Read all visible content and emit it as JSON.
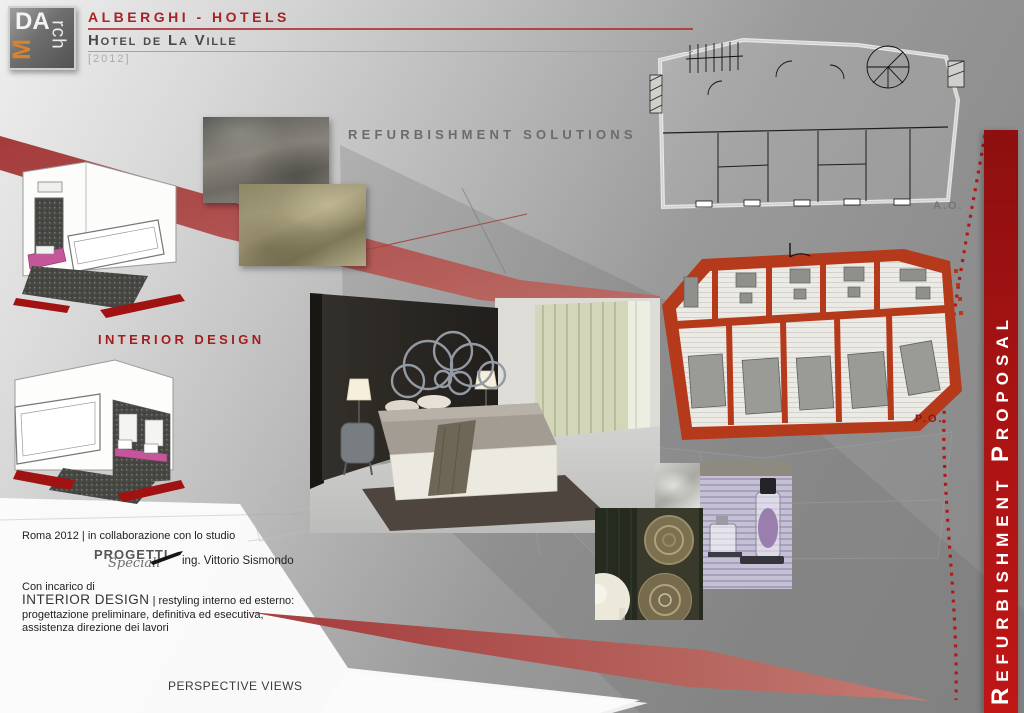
{
  "header": {
    "logo": {
      "part_da": "DA",
      "part_m": "M",
      "part_rch": "rch"
    },
    "category_label": "ALBERGHI - HOTELS",
    "project_title": "Hotel de La Ville",
    "project_year": "[2012]"
  },
  "labels": {
    "refurbishment_solutions": "REFURBISHMENT SOLUTIONS",
    "interior_design": "INTERIOR DESIGN",
    "perspective_views": "PERSPECTIVE VIEWS",
    "plan_ante_operam": "A.O.",
    "plan_post_operam": "P.O."
  },
  "sidebar": {
    "title": "Refurbishment Proposal"
  },
  "credits": {
    "collaboration_line": "Roma 2012 | in collaborazione con lo studio",
    "studio_name": "PROGETTI",
    "studio_name_script": "Speciali",
    "engineer_name": "ing. Vittorio Sismondo",
    "assignment_intro": "Con incarico di",
    "assignment_role": "INTERIOR DESIGN",
    "assignment_detail_1": "| restyling interno ed esterno:",
    "assignment_detail_2": "progettazione  preliminare,  definitiva  ed  esecutiva,",
    "assignment_detail_3": "assistenza direzione dei lavori"
  },
  "colors": {
    "accent_red": "#a82323",
    "sidebar_red": "#b01414",
    "plan_red": "#b5391b",
    "band_red": "#a63c3c",
    "logo_orange": "#d9822b",
    "heading_gray": "#6b6b6b"
  }
}
